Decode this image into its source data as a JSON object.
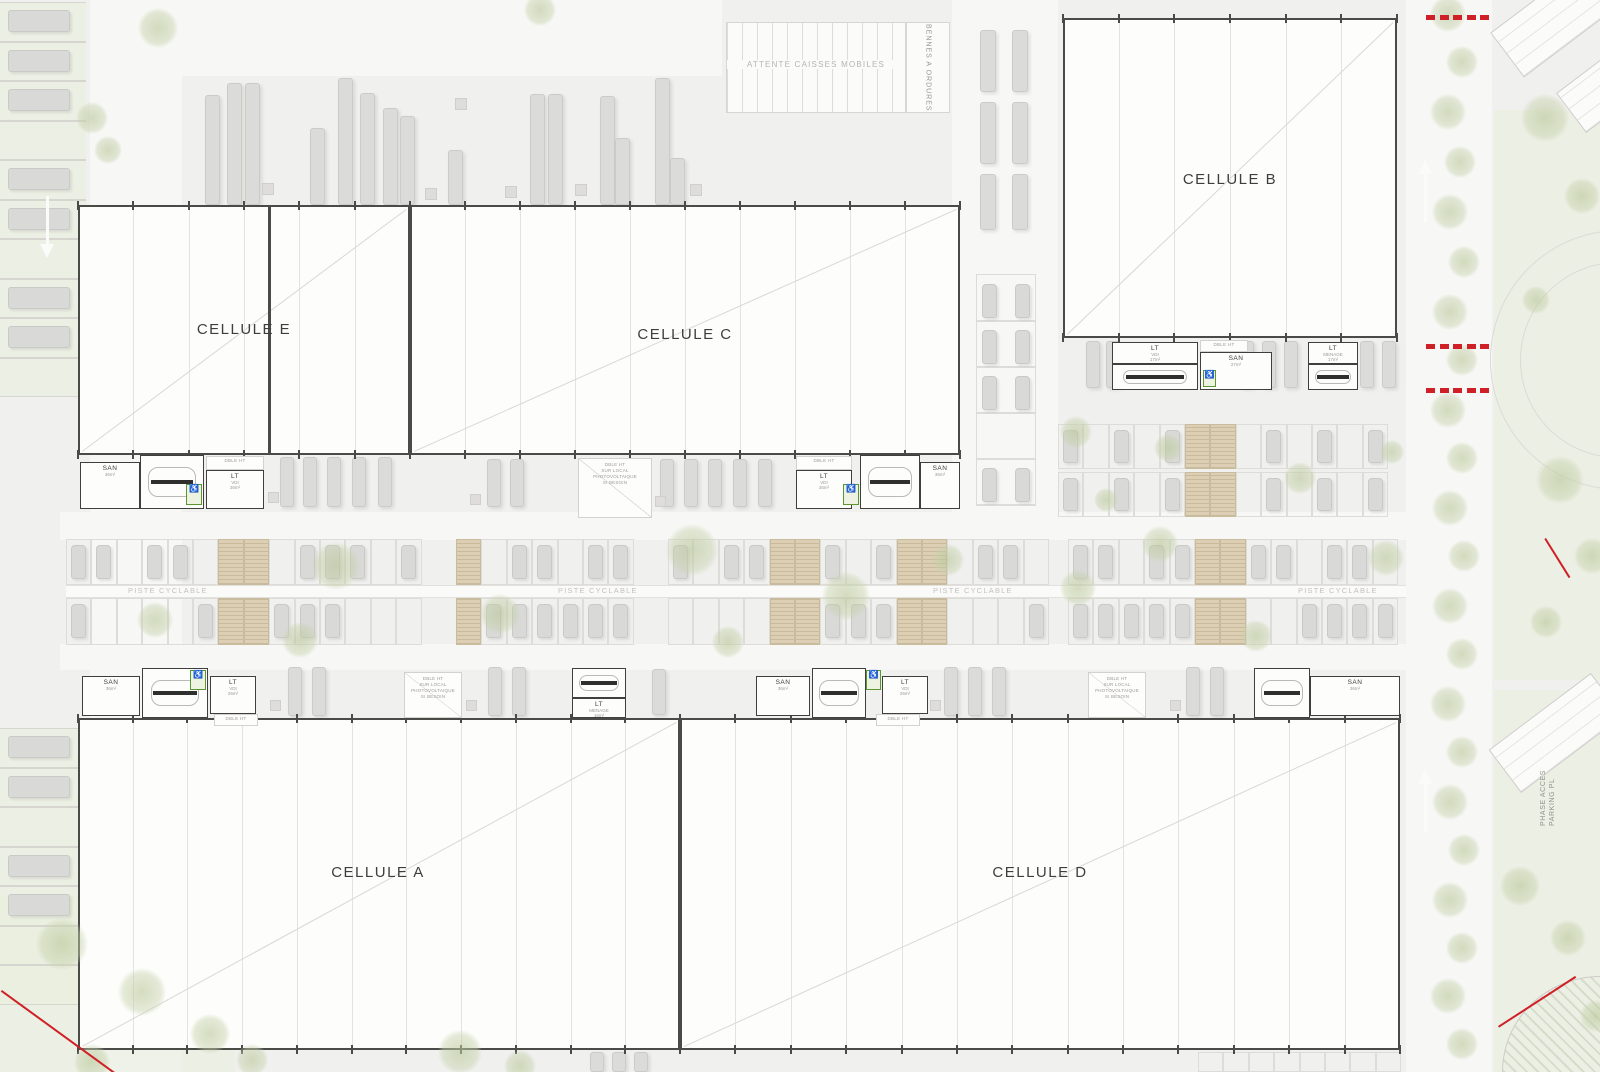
{
  "texts": {
    "attente": "ATTENTE CAISSES MOBILES",
    "bennes": "BENNES A ORDURES",
    "piste": "PISTE CYCLABLE",
    "phase_line1": "PHASE ACCES",
    "phase_line2": "PARKING PL",
    "dblht": "DBLE HT"
  },
  "pv_text": [
    "DBLE HT",
    "SUR LOCAL",
    "PHOTOVOLTAIQUE",
    "SI BESOIN"
  ],
  "colors": {
    "accent_red": "#cf2027",
    "building_border": "#4a4a47",
    "tree_green": "#c6d2ac",
    "ev_stall_tan": "#dccfb4"
  },
  "cells": [
    {
      "id": "E",
      "label": "CELLULE E",
      "x": 78,
      "y": 205,
      "w": 332,
      "h": 250,
      "lx": 166,
      "ly": 125,
      "bays": 6
    },
    {
      "id": "C",
      "label": "CELLULE C",
      "x": 410,
      "y": 205,
      "w": 550,
      "h": 250,
      "lx": 275,
      "ly": 130,
      "bays": 10
    },
    {
      "id": "B",
      "label": "CELLULE B",
      "x": 1063,
      "y": 18,
      "w": 334,
      "h": 320,
      "lx": 167,
      "ly": 162,
      "bays": 6
    },
    {
      "id": "A",
      "label": "CELLULE A",
      "x": 78,
      "y": 718,
      "w": 602,
      "h": 332,
      "lx": 300,
      "ly": 155,
      "bays": 11
    },
    {
      "id": "D",
      "label": "CELLULE D",
      "x": 680,
      "y": 718,
      "w": 720,
      "h": 332,
      "lx": 360,
      "ly": 155,
      "bays": 13
    }
  ],
  "firewalls": [
    {
      "x": 268,
      "y": 207,
      "w": 3,
      "h": 246
    },
    {
      "x": 408,
      "y": 207,
      "w": 3,
      "h": 246
    },
    {
      "x": 678,
      "y": 720,
      "w": 4,
      "h": 328
    }
  ],
  "annex_units": [
    {
      "kind": "san",
      "x": 80,
      "y": 462,
      "w": 60,
      "h": 47,
      "label": "SAN",
      "area": "36m²"
    },
    {
      "kind": "stairs",
      "x": 140,
      "y": 455,
      "w": 64,
      "h": 54
    },
    {
      "kind": "green",
      "x": 186,
      "y": 484,
      "w": 16,
      "h": 21
    },
    {
      "kind": "dblht",
      "x": 206,
      "y": 456,
      "w": 58,
      "h": 14
    },
    {
      "kind": "lt",
      "x": 206,
      "y": 470,
      "w": 58,
      "h": 39,
      "label": "LT",
      "sub": "VDI",
      "area": "26m²"
    },
    {
      "kind": "pv",
      "x": 578,
      "y": 458,
      "w": 74,
      "h": 60
    },
    {
      "kind": "dblht",
      "x": 796,
      "y": 456,
      "w": 56,
      "h": 14
    },
    {
      "kind": "lt",
      "x": 796,
      "y": 470,
      "w": 56,
      "h": 39,
      "label": "LT",
      "sub": "VDI",
      "area": "26m²"
    },
    {
      "kind": "green",
      "x": 843,
      "y": 484,
      "w": 16,
      "h": 21
    },
    {
      "kind": "stairs",
      "x": 860,
      "y": 455,
      "w": 60,
      "h": 54
    },
    {
      "kind": "san",
      "x": 920,
      "y": 462,
      "w": 40,
      "h": 47,
      "label": "SAN",
      "area": "36m²"
    },
    {
      "kind": "lt",
      "x": 1112,
      "y": 342,
      "w": 86,
      "h": 22,
      "label": "LT",
      "sub": "VDI",
      "area": "17m²"
    },
    {
      "kind": "stairs",
      "x": 1112,
      "y": 364,
      "w": 86,
      "h": 26
    },
    {
      "kind": "dblht",
      "x": 1200,
      "y": 340,
      "w": 48,
      "h": 12
    },
    {
      "kind": "san",
      "x": 1200,
      "y": 352,
      "w": 72,
      "h": 38,
      "label": "SAN",
      "area": "27m²"
    },
    {
      "kind": "green",
      "x": 1203,
      "y": 370,
      "w": 13,
      "h": 17
    },
    {
      "kind": "lt",
      "x": 1308,
      "y": 342,
      "w": 50,
      "h": 22,
      "label": "LT",
      "sub": "MENAGE",
      "area": "17m²"
    },
    {
      "kind": "stairs",
      "x": 1308,
      "y": 364,
      "w": 50,
      "h": 26
    },
    {
      "kind": "san",
      "x": 82,
      "y": 676,
      "w": 58,
      "h": 40,
      "label": "SAN",
      "area": "36m²"
    },
    {
      "kind": "stairs",
      "x": 142,
      "y": 668,
      "w": 66,
      "h": 50
    },
    {
      "kind": "green",
      "x": 190,
      "y": 670,
      "w": 16,
      "h": 20
    },
    {
      "kind": "lt",
      "x": 210,
      "y": 676,
      "w": 46,
      "h": 38,
      "label": "LT",
      "sub": "VDI",
      "area": "26m²"
    },
    {
      "kind": "dblht",
      "x": 214,
      "y": 714,
      "w": 44,
      "h": 12
    },
    {
      "kind": "pv",
      "x": 404,
      "y": 672,
      "w": 58,
      "h": 46
    },
    {
      "kind": "stairs",
      "x": 572,
      "y": 668,
      "w": 54,
      "h": 30
    },
    {
      "kind": "lt",
      "x": 572,
      "y": 698,
      "w": 54,
      "h": 20,
      "label": "LT",
      "sub": "MENAGE",
      "area": "16m²"
    },
    {
      "kind": "san",
      "x": 756,
      "y": 676,
      "w": 54,
      "h": 40,
      "label": "SAN",
      "area": "36m²"
    },
    {
      "kind": "stairs",
      "x": 812,
      "y": 668,
      "w": 54,
      "h": 50
    },
    {
      "kind": "green",
      "x": 866,
      "y": 670,
      "w": 15,
      "h": 20
    },
    {
      "kind": "lt",
      "x": 882,
      "y": 676,
      "w": 46,
      "h": 38,
      "label": "LT",
      "sub": "VDI",
      "area": "26m²"
    },
    {
      "kind": "dblht",
      "x": 876,
      "y": 714,
      "w": 44,
      "h": 12
    },
    {
      "kind": "pv",
      "x": 1088,
      "y": 672,
      "w": 58,
      "h": 46
    },
    {
      "kind": "stairs",
      "x": 1254,
      "y": 668,
      "w": 56,
      "h": 50
    },
    {
      "kind": "san",
      "x": 1310,
      "y": 676,
      "w": 90,
      "h": 40,
      "label": "SAN",
      "area": "36m²"
    }
  ],
  "layout": {
    "roads": [
      {
        "x": 90,
        "y": 0,
        "w": 92,
        "h": 1072
      },
      {
        "x": 60,
        "y": 512,
        "w": 1348,
        "h": 28
      },
      {
        "x": 60,
        "y": 644,
        "w": 1348,
        "h": 26
      },
      {
        "x": 1406,
        "y": 0,
        "w": 86,
        "h": 1072
      },
      {
        "x": 952,
        "y": 0,
        "w": 106,
        "h": 528
      },
      {
        "x": 182,
        "y": 0,
        "w": 540,
        "h": 76
      }
    ],
    "greens": [
      {
        "x": 1494,
        "y": 110,
        "w": 106,
        "h": 570
      },
      {
        "x": 1494,
        "y": 690,
        "w": 106,
        "h": 382
      },
      {
        "x": 0,
        "y": 896,
        "w": 235,
        "h": 176
      }
    ],
    "left_strips": [
      {
        "x": 0,
        "y": 2,
        "w": 86,
        "rows": 10,
        "rowH": 39.5,
        "carRows": [
          0,
          1,
          2,
          4,
          5,
          7,
          8
        ],
        "green": true
      },
      {
        "x": 0,
        "y": 728,
        "w": 86,
        "rows": 7,
        "rowH": 39.5,
        "carRows": [
          0,
          1,
          3,
          4
        ],
        "green": true
      }
    ],
    "mid_band": {
      "x": 66,
      "endX": 1406,
      "stallW": 25.4,
      "row1Y": 539,
      "row1H": 46,
      "stripY": 585,
      "stripH": 13,
      "row2Y": 598,
      "row2H": 47,
      "gaps": [
        [
          428,
          456
        ],
        [
          628,
          668
        ],
        [
          1038,
          1068
        ]
      ],
      "tan": [
        [
          220,
          272
        ],
        [
          451,
          479
        ],
        [
          774,
          832
        ],
        [
          903,
          936
        ],
        [
          1194,
          1252
        ]
      ]
    },
    "right_parking": {
      "x": 1058,
      "endX": 1406,
      "stallW": 25.4,
      "rows": [
        [
          424,
          45
        ],
        [
          472,
          45
        ]
      ],
      "tan": [
        [
          1180,
          1232
        ]
      ]
    },
    "col_outline": {
      "x": 976,
      "y": 274,
      "w": 60,
      "h": 232,
      "rowH": 46
    },
    "piste_labels": [
      {
        "x": 128,
        "y": 586
      },
      {
        "x": 558,
        "y": 586
      },
      {
        "x": 933,
        "y": 586
      },
      {
        "x": 1298,
        "y": 586
      }
    ],
    "trucks": [
      [
        205,
        95,
        15,
        110
      ],
      [
        227,
        83,
        15,
        122
      ],
      [
        245,
        83,
        15,
        122
      ],
      [
        310,
        128,
        15,
        77
      ],
      [
        338,
        78,
        15,
        127
      ],
      [
        360,
        93,
        15,
        112
      ],
      [
        383,
        108,
        15,
        97
      ],
      [
        400,
        116,
        15,
        89
      ],
      [
        448,
        150,
        15,
        55
      ],
      [
        530,
        94,
        15,
        111
      ],
      [
        548,
        94,
        15,
        111
      ],
      [
        600,
        96,
        15,
        109
      ],
      [
        615,
        138,
        15,
        67
      ],
      [
        655,
        78,
        15,
        127
      ],
      [
        670,
        158,
        15,
        47
      ],
      [
        280,
        457,
        14,
        50
      ],
      [
        303,
        457,
        14,
        50
      ],
      [
        327,
        457,
        14,
        50
      ],
      [
        352,
        457,
        14,
        50
      ],
      [
        378,
        457,
        14,
        50
      ],
      [
        487,
        459,
        14,
        48
      ],
      [
        510,
        459,
        14,
        48
      ],
      [
        660,
        459,
        14,
        48
      ],
      [
        684,
        459,
        14,
        48
      ],
      [
        708,
        459,
        14,
        48
      ],
      [
        733,
        459,
        14,
        48
      ],
      [
        758,
        459,
        14,
        48
      ],
      [
        980,
        30,
        16,
        62
      ],
      [
        1012,
        30,
        16,
        62
      ],
      [
        980,
        102,
        16,
        62
      ],
      [
        1012,
        102,
        16,
        62
      ],
      [
        980,
        174,
        16,
        56
      ],
      [
        1012,
        174,
        16,
        56
      ],
      [
        1086,
        341,
        14,
        47
      ],
      [
        1106,
        341,
        14,
        47
      ],
      [
        1240,
        341,
        14,
        47
      ],
      [
        1262,
        341,
        14,
        47
      ],
      [
        1284,
        341,
        14,
        47
      ],
      [
        1360,
        341,
        14,
        47
      ],
      [
        1382,
        341,
        14,
        47
      ],
      [
        288,
        667,
        14,
        49
      ],
      [
        312,
        667,
        14,
        49
      ],
      [
        488,
        667,
        14,
        49
      ],
      [
        512,
        667,
        14,
        49
      ],
      [
        652,
        669,
        14,
        46
      ],
      [
        944,
        667,
        14,
        49
      ],
      [
        968,
        667,
        14,
        49
      ],
      [
        992,
        667,
        14,
        49
      ],
      [
        1186,
        667,
        14,
        49
      ],
      [
        1210,
        667,
        14,
        49
      ],
      [
        590,
        1052,
        14,
        20
      ],
      [
        612,
        1052,
        14,
        20
      ],
      [
        634,
        1052,
        14,
        20
      ]
    ],
    "dock_squares": [
      [
        262,
        183,
        12,
        12
      ],
      [
        425,
        188,
        12,
        12
      ],
      [
        455,
        98,
        12,
        12
      ],
      [
        505,
        186,
        12,
        12
      ],
      [
        575,
        184,
        12,
        12
      ],
      [
        690,
        184,
        12,
        12
      ],
      [
        268,
        492,
        11,
        11
      ],
      [
        470,
        494,
        11,
        11
      ],
      [
        655,
        496,
        11,
        11
      ],
      [
        270,
        700,
        11,
        11
      ],
      [
        466,
        700,
        11,
        11
      ],
      [
        930,
        700,
        11,
        11
      ],
      [
        1170,
        700,
        11,
        11
      ]
    ],
    "cars": [
      [
        982,
        284,
        15,
        34
      ],
      [
        1015,
        284,
        15,
        34
      ],
      [
        982,
        330,
        15,
        34
      ],
      [
        1015,
        330,
        15,
        34
      ],
      [
        982,
        376,
        15,
        34
      ],
      [
        1015,
        376,
        15,
        34
      ],
      [
        982,
        468,
        15,
        34
      ],
      [
        1015,
        468,
        15,
        34
      ]
    ],
    "trees": [
      [
        158,
        28,
        20
      ],
      [
        540,
        10,
        16
      ],
      [
        92,
        118,
        16
      ],
      [
        108,
        150,
        14
      ],
      [
        336,
        566,
        24
      ],
      [
        300,
        640,
        18
      ],
      [
        500,
        614,
        20
      ],
      [
        692,
        550,
        26
      ],
      [
        728,
        642,
        16
      ],
      [
        846,
        596,
        24
      ],
      [
        948,
        560,
        16
      ],
      [
        1078,
        588,
        18
      ],
      [
        1160,
        544,
        18
      ],
      [
        1256,
        636,
        16
      ],
      [
        1386,
        558,
        18
      ],
      [
        155,
        620,
        18
      ],
      [
        1076,
        432,
        16
      ],
      [
        1168,
        448,
        14
      ],
      [
        1300,
        478,
        16
      ],
      [
        1392,
        452,
        12
      ],
      [
        1106,
        500,
        12
      ],
      [
        1448,
        14,
        18
      ],
      [
        1462,
        62,
        16
      ],
      [
        1448,
        112,
        18
      ],
      [
        1460,
        162,
        16
      ],
      [
        1450,
        212,
        18
      ],
      [
        1464,
        262,
        16
      ],
      [
        1450,
        312,
        18
      ],
      [
        1462,
        360,
        16
      ],
      [
        1448,
        410,
        18
      ],
      [
        1462,
        458,
        16
      ],
      [
        1450,
        508,
        18
      ],
      [
        1464,
        556,
        16
      ],
      [
        1450,
        606,
        18
      ],
      [
        1462,
        654,
        16
      ],
      [
        1448,
        704,
        18
      ],
      [
        1462,
        752,
        16
      ],
      [
        1450,
        802,
        18
      ],
      [
        1464,
        850,
        16
      ],
      [
        1450,
        900,
        18
      ],
      [
        1462,
        948,
        16
      ],
      [
        1448,
        996,
        18
      ],
      [
        1462,
        1044,
        16
      ],
      [
        1545,
        118,
        24
      ],
      [
        1582,
        196,
        18
      ],
      [
        1536,
        300,
        14
      ],
      [
        1560,
        480,
        24
      ],
      [
        1592,
        556,
        18
      ],
      [
        1546,
        622,
        16
      ],
      [
        1520,
        886,
        20
      ],
      [
        1568,
        938,
        18
      ],
      [
        1596,
        1016,
        16
      ],
      [
        62,
        944,
        26
      ],
      [
        142,
        992,
        24
      ],
      [
        210,
        1034,
        20
      ],
      [
        92,
        1062,
        18
      ],
      [
        252,
        1060,
        16
      ],
      [
        460,
        1052,
        22
      ],
      [
        520,
        1066,
        16
      ]
    ],
    "red_dash_groups": [
      {
        "x": 1426,
        "y": 15,
        "n": 5
      },
      {
        "x": 1426,
        "y": 344,
        "n": 5
      },
      {
        "x": 1426,
        "y": 388,
        "n": 5
      }
    ],
    "red_lines": [
      {
        "x": 2,
        "y": 990,
        "len": 142,
        "rot": 36
      },
      {
        "x": 1546,
        "y": 538,
        "len": 46,
        "rot": 58
      },
      {
        "x": 1498,
        "y": 1026,
        "len": 92,
        "rot": -33
      }
    ],
    "arrows": [
      {
        "x": 47,
        "y": 196,
        "dir": "down",
        "len": 62
      },
      {
        "x": 1425,
        "y": 160,
        "dir": "up",
        "len": 62
      },
      {
        "x": 1425,
        "y": 770,
        "dir": "up",
        "len": 62
      }
    ],
    "slabs": [
      {
        "x": 1492,
        "y": -18,
        "w": 150,
        "h": 56,
        "rot": -37
      },
      {
        "x": 1560,
        "y": 55,
        "w": 110,
        "h": 50,
        "rot": -37
      },
      {
        "x": 1492,
        "y": 706,
        "w": 128,
        "h": 54,
        "rot": -37
      }
    ],
    "arcs": [
      {
        "x": 1490,
        "y": 230,
        "d": 260
      },
      {
        "x": 1520,
        "y": 262,
        "d": 196
      }
    ],
    "quarter": {
      "x": 1502,
      "y": 976,
      "w": 98,
      "h": 96
    },
    "compass": {
      "x": 394,
      "y": 999,
      "d": 26
    },
    "extra_stalls": [
      {
        "x": 1198,
        "y": 1052,
        "n": 8,
        "w": 25.4,
        "h": 20
      }
    ],
    "attente": {
      "x": 726,
      "y": 22,
      "w": 180,
      "h": 91
    },
    "bennes": {
      "x": 906,
      "y": 22,
      "w": 44,
      "h": 91
    },
    "phase": {
      "x": 1540,
      "y": 726,
      "h": 100
    }
  }
}
